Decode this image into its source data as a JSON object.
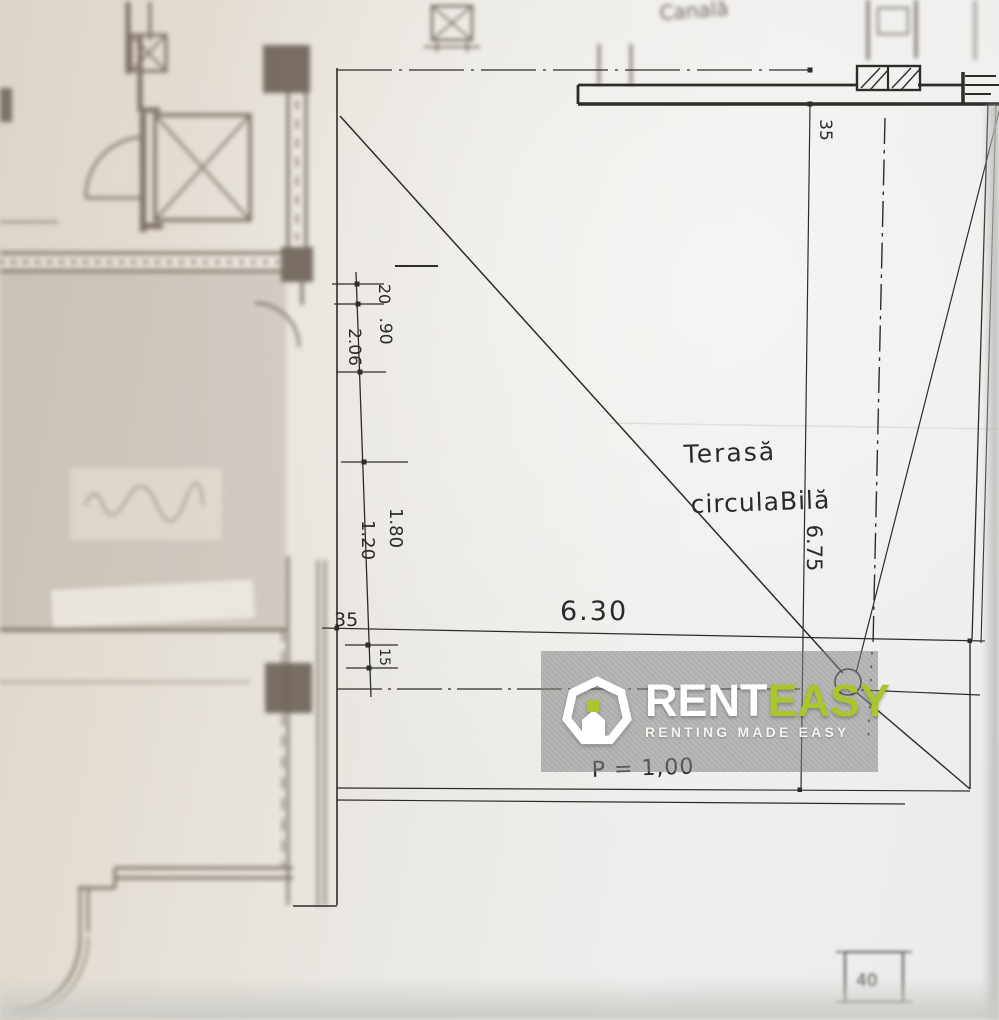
{
  "watermark": {
    "brand_primary": "RENT",
    "brand_secondary": "EASY",
    "tagline": "RENTING MADE EASY",
    "accent_color": "#a9c62c"
  },
  "plan": {
    "room_label_line1": "Terasă",
    "room_label_line2": "circulaBilă",
    "slope_note": "P = 1,00",
    "duct_note": "Canală",
    "dimensions": {
      "total_width": "6.30",
      "total_height": "6.75",
      "top_offset": "35",
      "left_offset": "35",
      "seg_a": "20",
      "seg_b": ".90",
      "seg_c": "2.06",
      "seg_d": "1.20",
      "seg_e": "1.80",
      "seg_f": "15",
      "detail_square": "40"
    }
  },
  "colors": {
    "ink": "#2e2c29",
    "blurred_ink": "#7d7064",
    "paper_warm": "#e2dbd1",
    "paper_cool": "#edeeec",
    "watermark_band": "#7c7e7c",
    "accent": "#a9c62c"
  }
}
